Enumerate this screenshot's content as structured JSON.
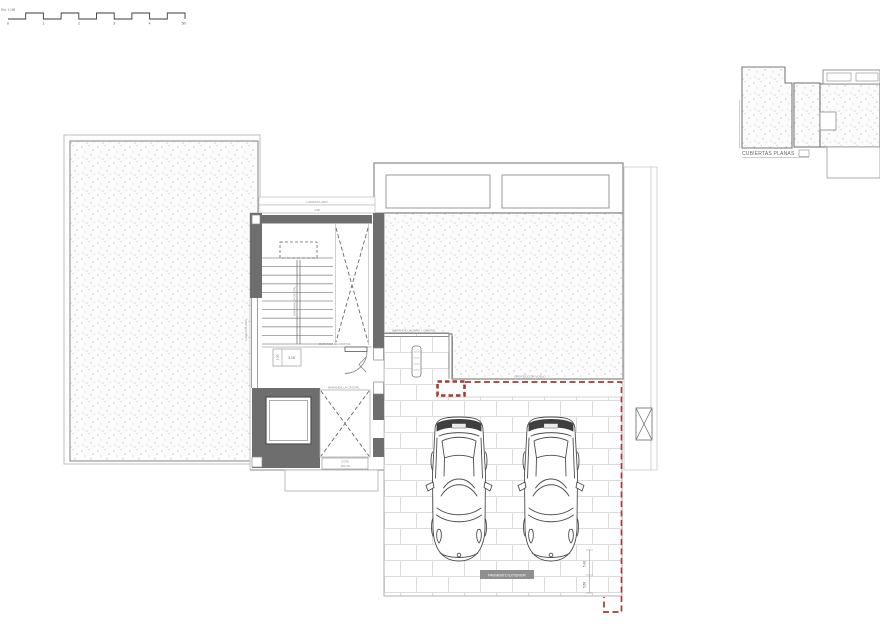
{
  "colors": {
    "red_dash": "#a93a2c",
    "wall_dark": "#6e6e6e",
    "line_gray": "#8a8a8a",
    "tile_line": "#dcdcdc",
    "stipple_dot": "#c5c5c5"
  },
  "scalebar": {
    "esc": "Esc. 1:100",
    "ticks": [
      "0",
      "1",
      "2",
      "3",
      "4",
      "5m"
    ]
  },
  "labels": {
    "lamas_plano": "LAMAS PLANO",
    "lamas_dim": "4.90",
    "barandilla_cristal": "BARANDILLA CRISTAL",
    "barandilla_obra_cristal": "BARANDILLA OBRA + CRISTAL",
    "proyeccion_vuelo": "PROYECCIÓN VUELO",
    "dim_310": "3.10",
    "dim_150": "1.50",
    "dim_540": "5.40",
    "dim_568": "5.68",
    "cota_1": "COTA",
    "cota_2": "150.78",
    "pavimento": "PAVIMENTO EXTERIOR",
    "keyplan_title": "CUBIERTAS PLANAS"
  }
}
